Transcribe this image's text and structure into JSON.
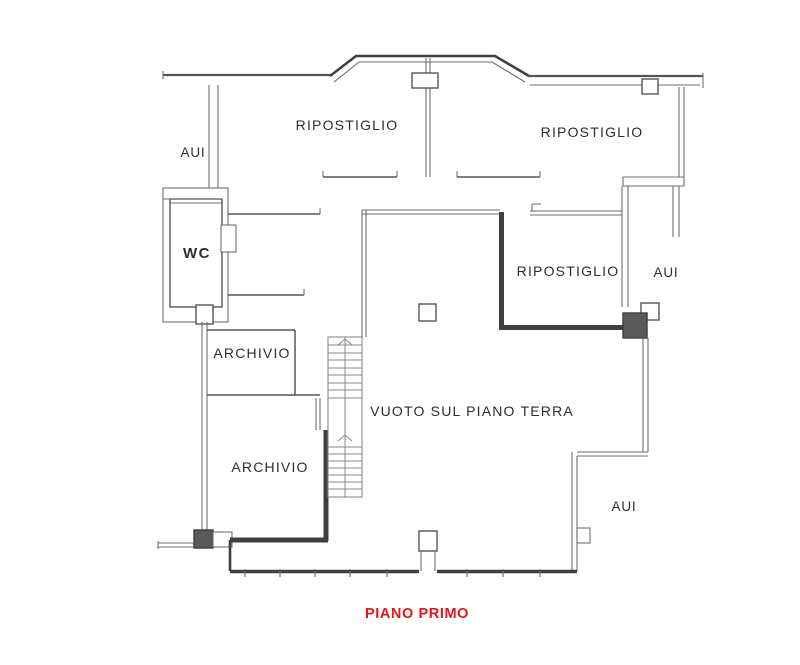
{
  "drawing": {
    "floor_title": "PIANO PRIMO",
    "rooms": {
      "aui_top_left": "AUI",
      "ripostiglio_top_left": "RIPOSTIGLIO",
      "ripostiglio_top_right": "RIPOSTIGLIO",
      "wc": "WC",
      "ripostiglio_mid_right": "RIPOSTIGLIO",
      "aui_mid_right": "AUI",
      "archivio_upper": "ARCHIVIO",
      "archivio_lower": "ARCHIVIO",
      "void_over_ground_floor": "VUOTO SUL PIANO TERRA",
      "aui_bottom_right": "AUI"
    },
    "colors": {
      "background": "#ffffff",
      "wall_thin": "#6e6e6e",
      "wall_mid": "#555555",
      "wall_dark": "#3f3f3f",
      "label_text": "#2d2d2d",
      "title_text": "#e01818"
    }
  }
}
